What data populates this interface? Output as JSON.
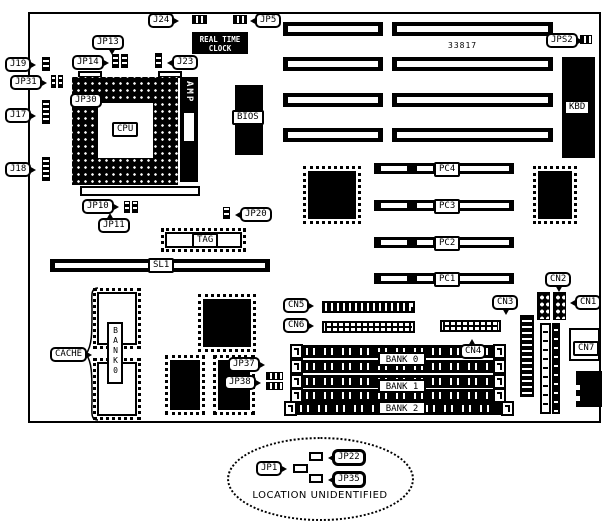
{
  "diagram": {
    "part_number": "33817",
    "rtc_line1": "REAL TIME",
    "rtc_line2": "CLOCK",
    "caption": "LOCATION UNIDENTIFIED",
    "colors": {
      "foreground": "#000000",
      "background": "#ffffff"
    }
  },
  "labels": {
    "j24": "J24",
    "jp5": "JP5",
    "jps2": "JPS2",
    "jp13": "JP13",
    "jp14": "JP14",
    "j23": "J23",
    "j19": "J19",
    "jp31": "JP31",
    "jp30": "JP30",
    "j17": "J17",
    "j18": "J18",
    "jp10": "JP10",
    "jp11": "JP11",
    "jp20": "JP20",
    "kbd": "KBD",
    "cpu": "CPU",
    "amp": "AMP",
    "bios": "BIOS",
    "tag": "TAG",
    "sl1": "SL1",
    "cache": "CACHE",
    "bank0_chip": "BANK0",
    "jp37": "JP37",
    "jp38": "JP38",
    "cn1": "CN1",
    "cn2": "CN2",
    "cn3": "CN3",
    "cn4": "CN4",
    "cn5": "CN5",
    "cn6": "CN6",
    "cn7": "CN7",
    "jp1": "JP1",
    "jp22": "JP22",
    "jp35": "JP35"
  },
  "slots": {
    "pci": {
      "pc1": "PC1",
      "pc2": "PC2",
      "pc3": "PC3",
      "pc4": "PC4"
    },
    "memory": {
      "bank0": "BANK 0",
      "bank1": "BANK 1",
      "bank2": "BANK 2"
    }
  }
}
